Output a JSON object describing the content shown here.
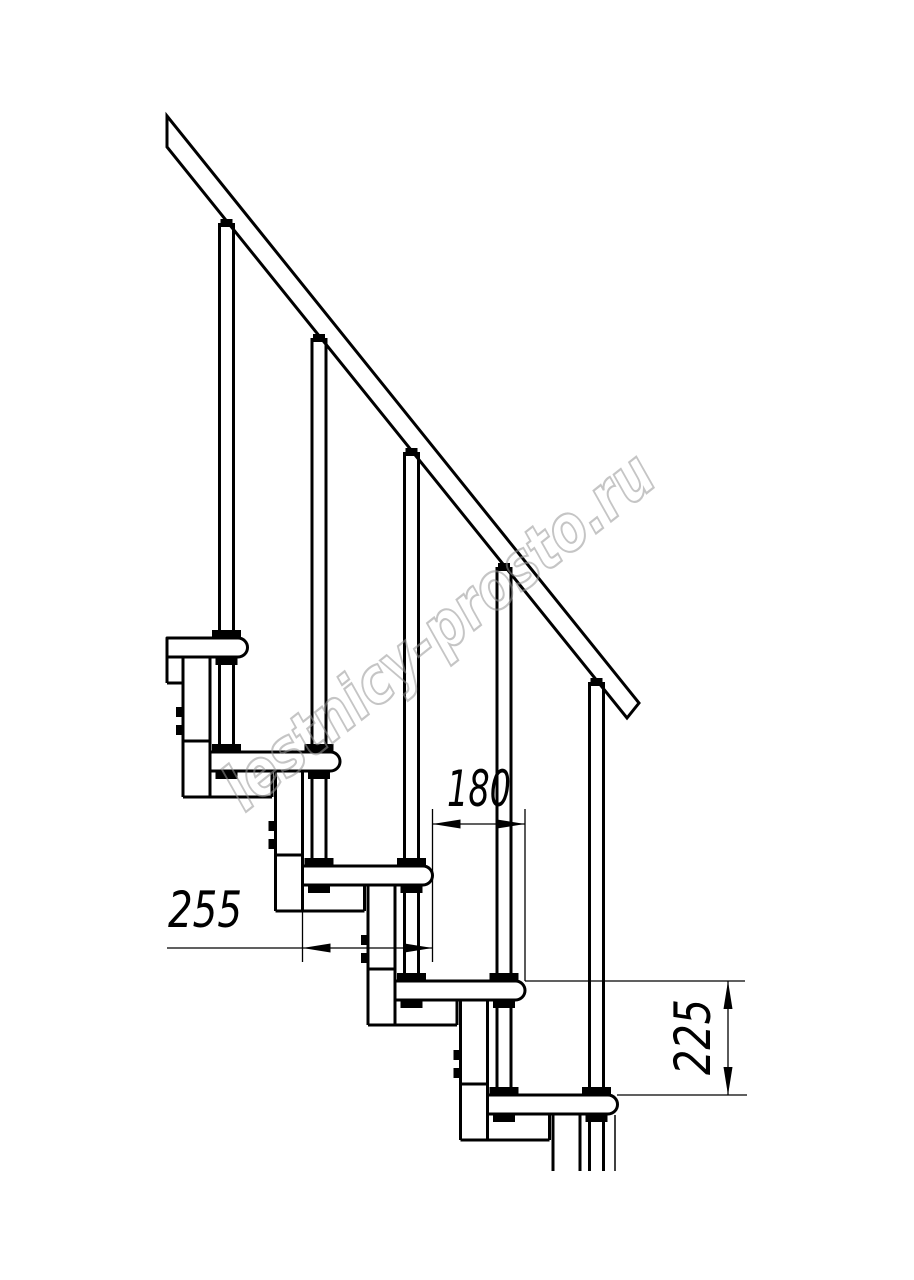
{
  "dimensions": {
    "tread_depth": "255",
    "going": "180",
    "riser_height": "225"
  },
  "watermark": {
    "text": "lestnicy-prosto.ru"
  },
  "colors": {
    "line": "#000000",
    "watermark": "#999999",
    "background": "#ffffff"
  }
}
